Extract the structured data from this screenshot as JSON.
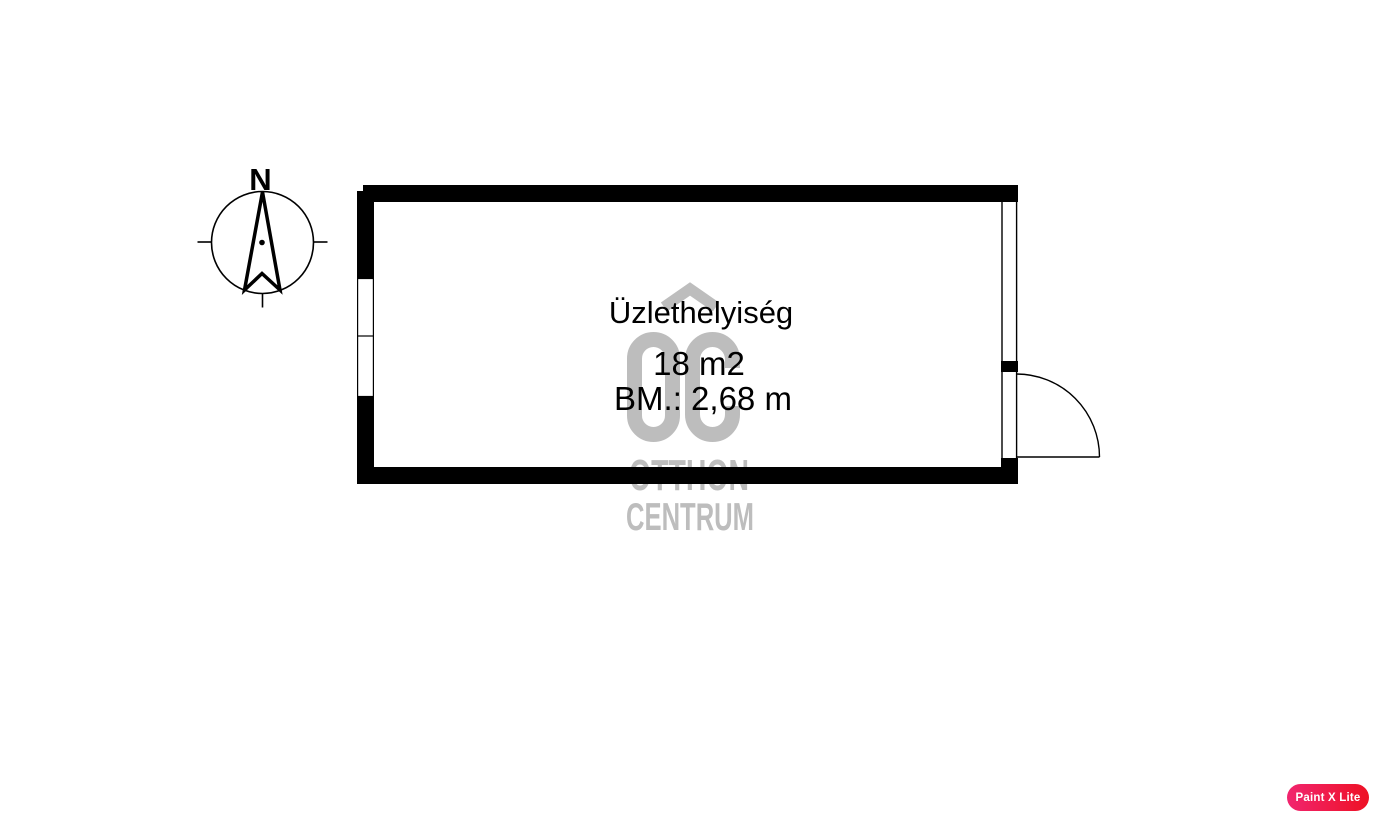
{
  "page": {
    "background_color": "#ffffff"
  },
  "compass": {
    "north_label": "N",
    "line_color": "#000000"
  },
  "floorplan": {
    "wall_color": "#000000",
    "room": {
      "name": "Üzlethelyiség",
      "area": "18 m2",
      "ceiling_height": "BM.: 2,68 m",
      "text_color": "#000000"
    },
    "features": {
      "left_wall_window": "double-window-icon",
      "right_wall_window": "window-icon",
      "right_wall_door": "door-swing-icon"
    }
  },
  "watermark": {
    "logo": "OC",
    "line1": "OTTHON",
    "line2": "CENTRUM",
    "color": "#bdbdbd"
  },
  "badge": {
    "label": "Paint X Lite",
    "gradient_start": "#f1256f",
    "gradient_end": "#ee1124",
    "text_color": "#ffffff"
  }
}
